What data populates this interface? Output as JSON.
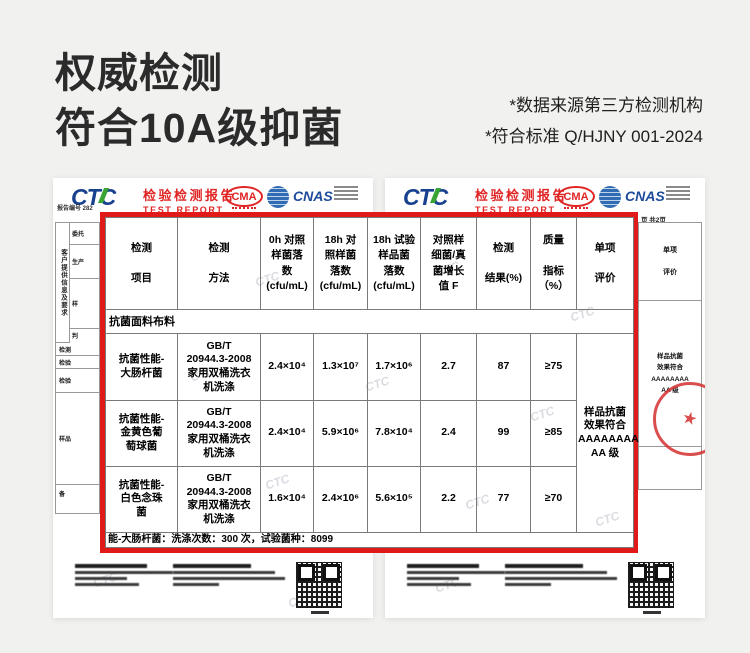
{
  "page": {
    "title_line1": "权威检测",
    "title_line2": "符合10A级抑菌",
    "disclaimer_line1": "*数据来源第三方检测机构",
    "disclaimer_line2": "*符合标准 Q/HJNY 001-2024"
  },
  "report_header": {
    "logo_text": "CTC",
    "title_cn": "检验检测报告",
    "title_en": "TEST REPORT",
    "cma_label": "CMA",
    "cnas_label": "CNAS"
  },
  "left_doc": {
    "report_no": "报告编号 282",
    "side_header_vertical": "客户提供信息及要求",
    "side_rows": [
      "委托",
      "生产",
      "样",
      "判",
      "检测",
      "检验",
      "检验",
      "样品",
      "备"
    ]
  },
  "right_doc": {
    "page_info": "页 共2页",
    "strip_header": "单项\n\n评价",
    "strip_result": "样品抗菌\n效果符合\nAAAAAAAA\nAA 级",
    "stamp_glyph": "★"
  },
  "table": {
    "headers": [
      "检测\n\n项目",
      "检测\n\n方法",
      "0h 对照\n样菌落\n数\n(cfu/mL)",
      "18h 对\n照样菌\n落数\n(cfu/mL)",
      "18h 试验\n样品菌\n落数\n(cfu/mL)",
      "对照样\n细菌/真\n菌增长\n值 F",
      "检测\n\n结果(%)",
      "质量\n\n指标\n（%）",
      "单项\n\n评价"
    ],
    "section_title": "抗菌面料布料",
    "rows": [
      {
        "cells": [
          "抗菌性能-\n大肠杆菌",
          "GB/T\n20944.3-2008\n家用双桶洗衣\n机洗涤",
          "2.4×10⁴",
          "1.3×10⁷",
          "1.7×10⁶",
          "2.7",
          "87",
          "≥75"
        ]
      },
      {
        "cells": [
          "抗菌性能-\n金黄色葡\n萄球菌",
          "GB/T\n20944.3-2008\n家用双桶洗衣\n机洗涤",
          "2.4×10⁴",
          "5.9×10⁶",
          "7.8×10⁴",
          "2.4",
          "99",
          "≥85"
        ]
      },
      {
        "cells": [
          "抗菌性能-\n白色念珠\n菌",
          "GB/T\n20944.3-2008\n家用双桶洗衣\n机洗涤",
          "1.6×10⁴",
          "2.4×10⁶",
          "5.6×10⁵",
          "2.2",
          "77",
          "≥70"
        ]
      }
    ],
    "evaluation_merged": "样品抗菌\n效果符合\nAAAAAAAA\nAA 级",
    "footnote": "能-大肠杆菌：洗涤次数：300 次，试验菌种：8099"
  },
  "watermark": {
    "text": "CTC"
  },
  "colors": {
    "bg": "#f1f1ef",
    "heading": "#2b2b2b",
    "frame-red": "#e11919",
    "report-red": "#e02424",
    "ctc-blue": "#17418f",
    "ctc-green": "#3aa535",
    "cnas-blue": "#1d4a9b",
    "ilac-blue": "#2f6cb3",
    "stamp-red": "#d43030"
  }
}
